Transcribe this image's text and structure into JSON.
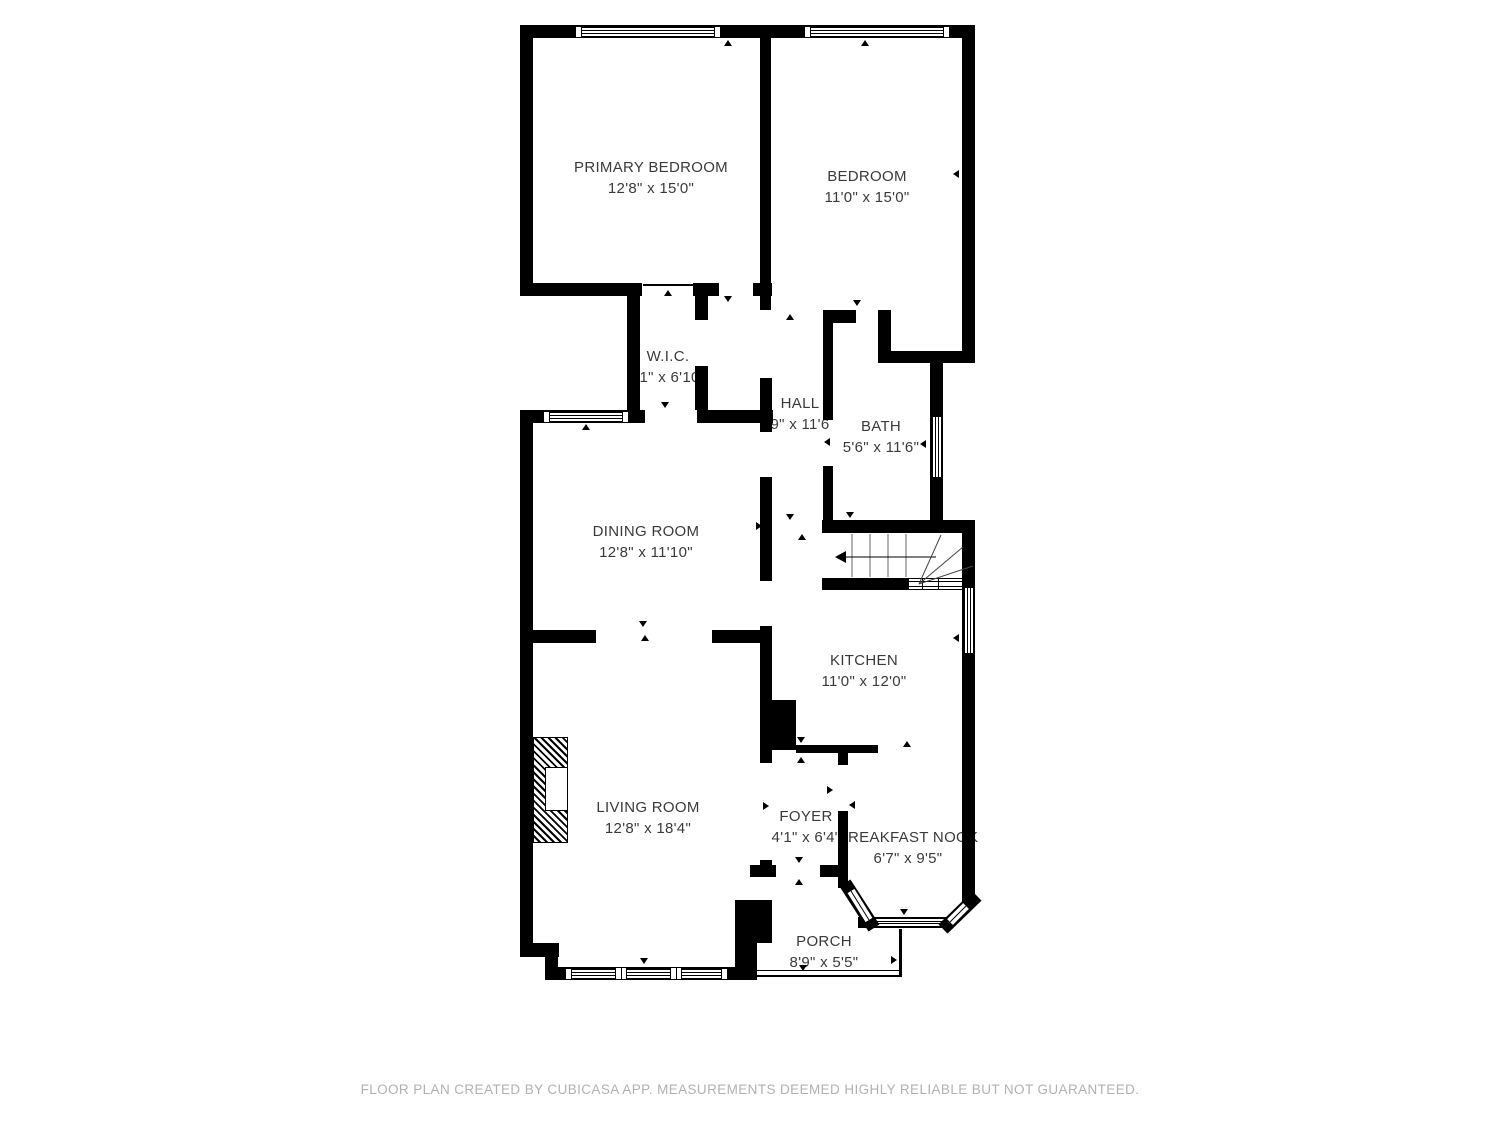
{
  "rooms": [
    {
      "name": "PRIMARY BEDROOM",
      "dims": "12'8\" x 15'0\""
    },
    {
      "name": "BEDROOM",
      "dims": "11'0\" x 15'0\""
    },
    {
      "name": "W.I.C.",
      "dims": "'1\" x 6'10"
    },
    {
      "name": "HALL",
      "dims": "9\" x 11'6"
    },
    {
      "name": "BATH",
      "dims": "5'6\" x 11'6\""
    },
    {
      "name": "DINING ROOM",
      "dims": "12'8\" x 11'10\""
    },
    {
      "name": "KITCHEN",
      "dims": "11'0\" x 12'0\""
    },
    {
      "name": "LIVING ROOM",
      "dims": "12'8\" x 18'4\""
    },
    {
      "name": "FOYER",
      "dims": "4'1\" x 6'4\""
    },
    {
      "name": "BREAKFAST NOOK",
      "dims": "6'7\" x 9'5\""
    },
    {
      "name": "PORCH",
      "dims": "8'9\" x 5'5\""
    }
  ],
  "footer": {
    "text": "FLOOR PLAN CREATED BY CUBICASA APP. MEASUREMENTS DEEMED HIGHLY RELIABLE BUT NOT GUARANTEED."
  },
  "colors": {
    "wall": "#000000",
    "label_text": "#3a3a3a",
    "footer_text": "#b3b0b0"
  }
}
